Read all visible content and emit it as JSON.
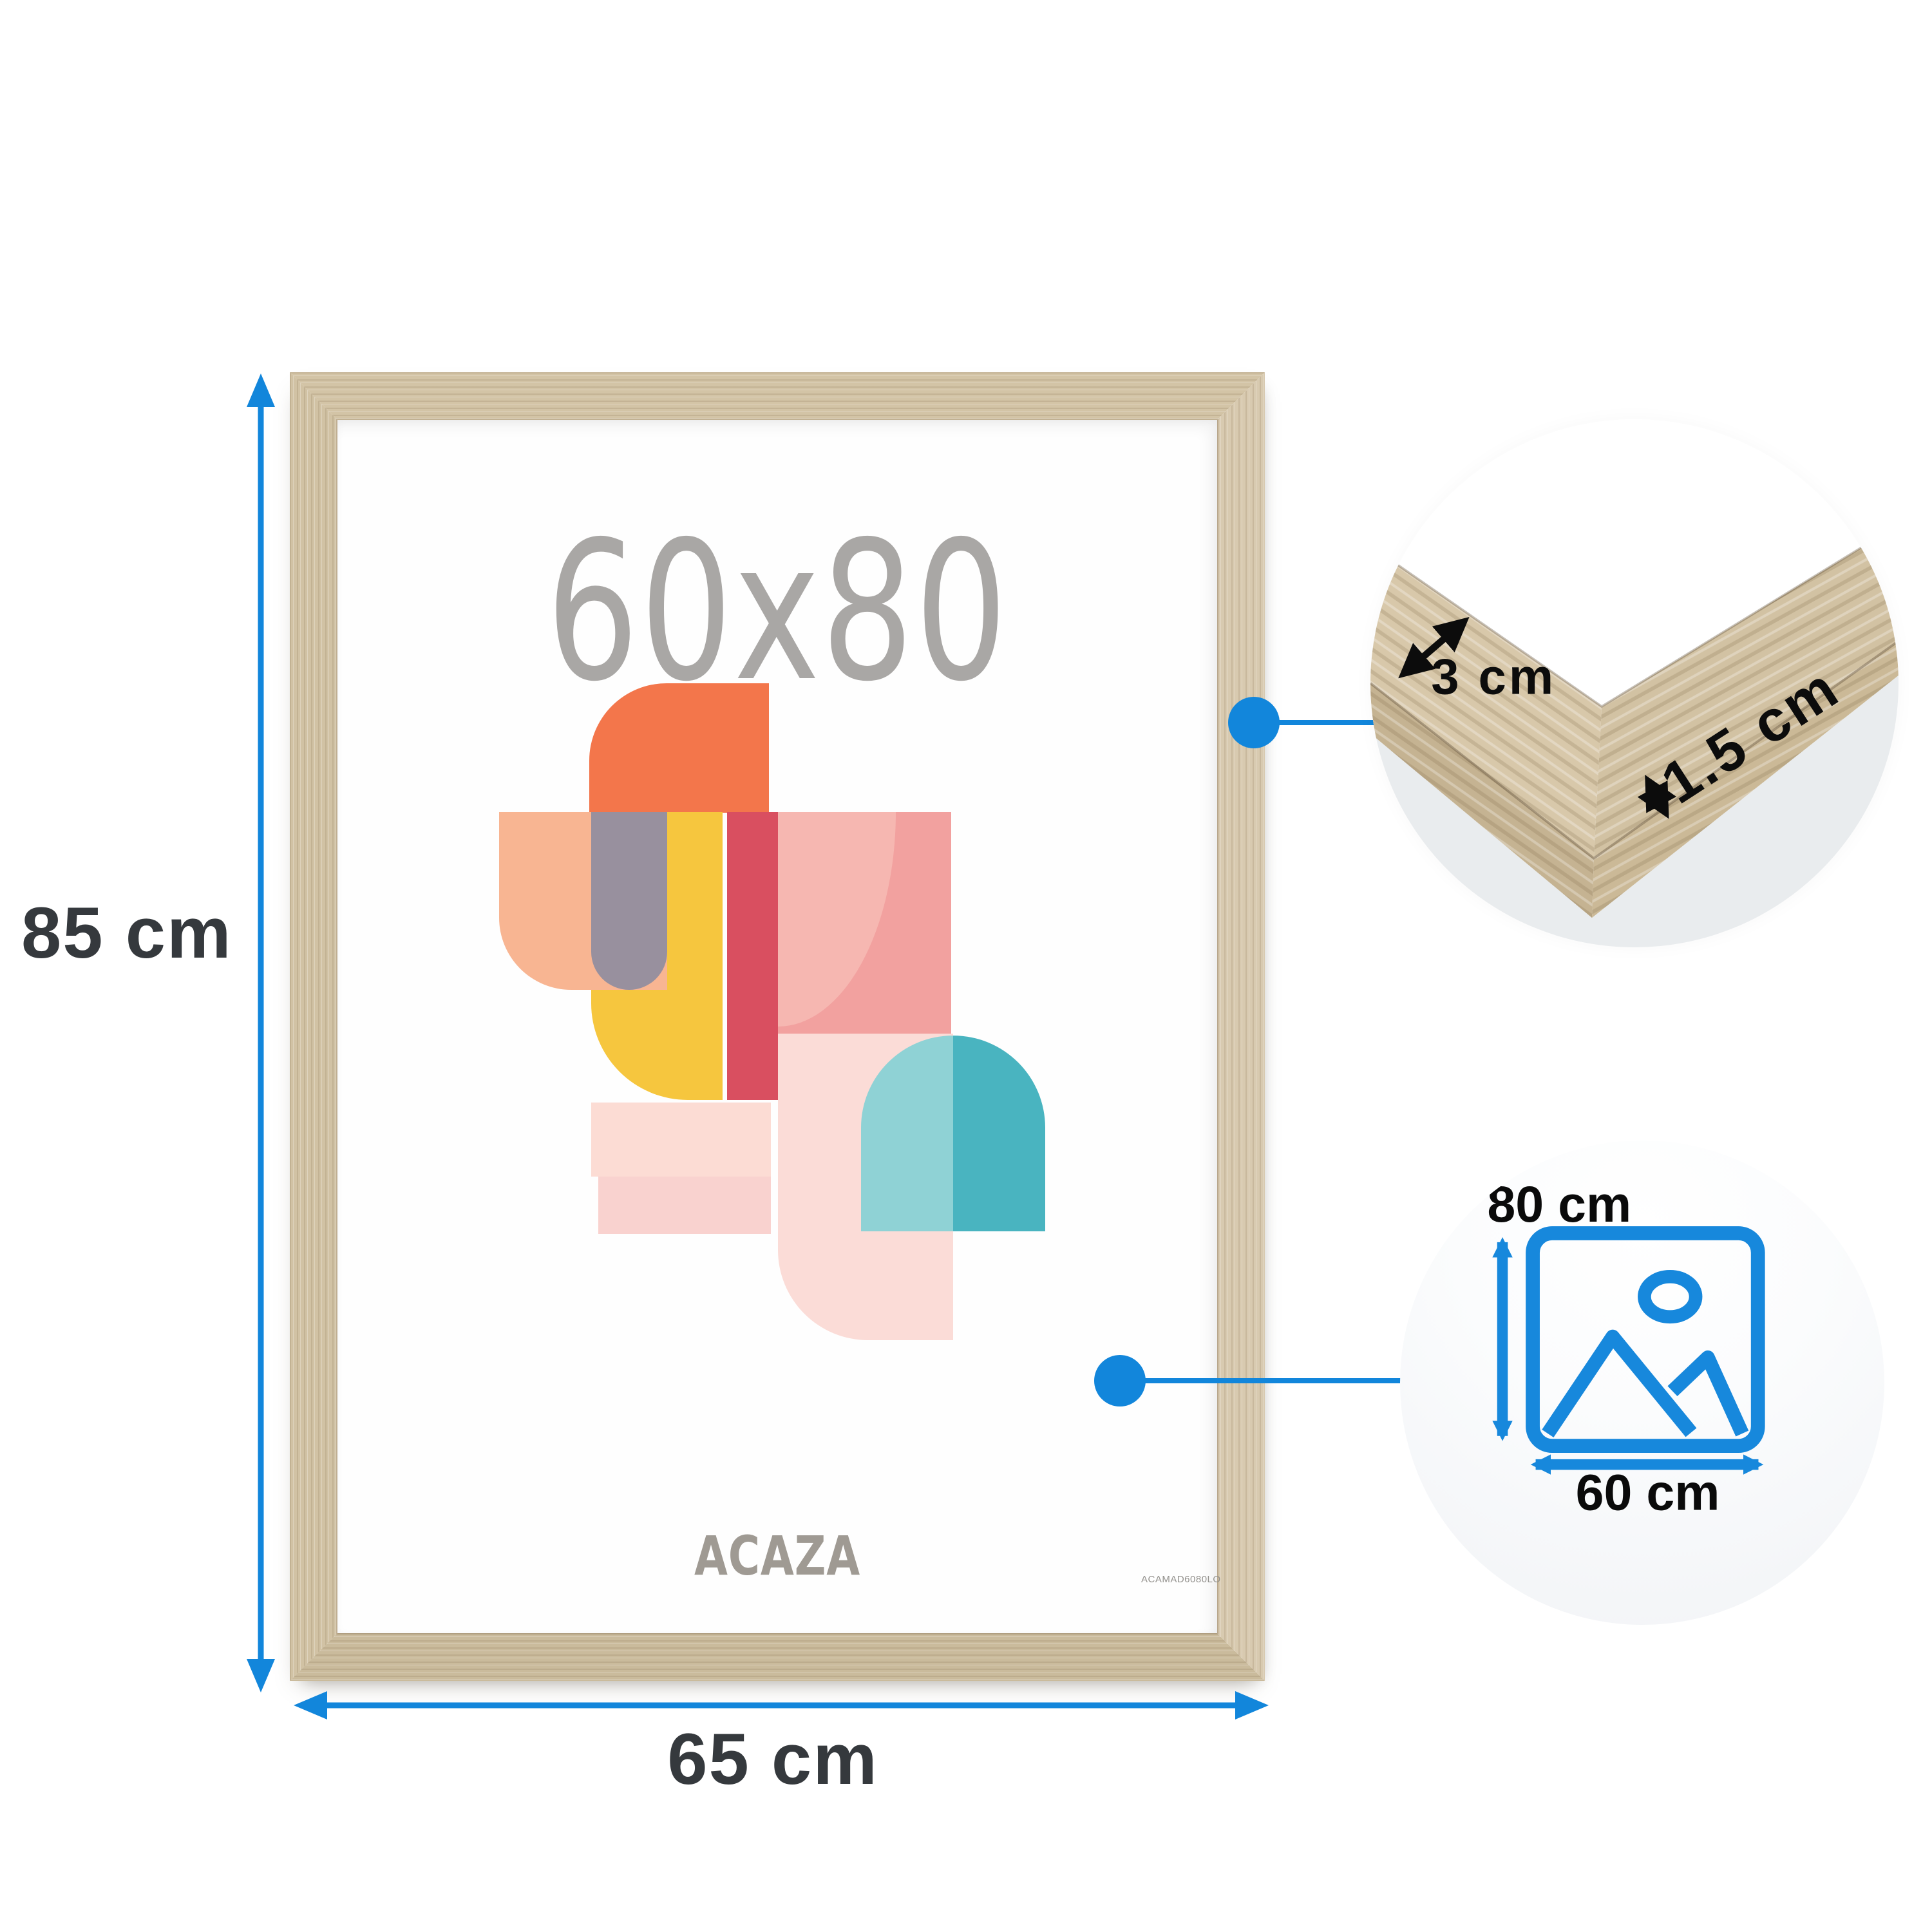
{
  "poster": {
    "size_text": "60x80",
    "brand": "ACAZA",
    "product_code": "ACAMAD6080LO"
  },
  "dimension_labels": {
    "frame_height": "85 cm",
    "frame_width": "65 cm",
    "profile_face": "3 cm",
    "profile_thickness": "1.5 cm",
    "picture_height": "80 cm",
    "picture_width": "60 cm"
  },
  "colors": {
    "accent_blue": "#1286DB",
    "label_dark": "#35393d",
    "wood_light_oak": "#d3c4a6",
    "poster_gray_text": "#a9a7a5",
    "art_orange": "#f3764b",
    "art_peach": "#f8b592",
    "art_gray": "#98909e",
    "art_yellow": "#f6c63e",
    "art_red": "#d94f60",
    "art_pink": "#f2a19f",
    "art_light_pink": "#fbdcd7",
    "art_teal_dark": "#49b4c0",
    "art_teal_light": "#8fd2d5"
  }
}
